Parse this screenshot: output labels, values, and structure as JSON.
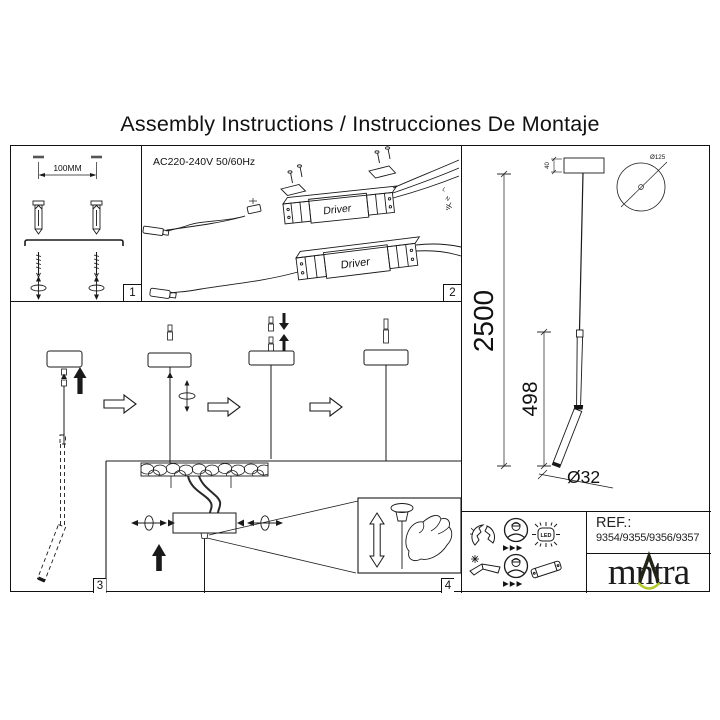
{
  "title": "Assembly Instructions / Instrucciones De Montaje",
  "panel1": {
    "label": "1",
    "dim_label": "100MM"
  },
  "panel2": {
    "label": "2",
    "power": "AC220-240V 50/60Hz",
    "driver_label": "Driver",
    "wire_live": "L",
    "wire_neutral": "N"
  },
  "panel3": {
    "label": "3"
  },
  "panel4": {
    "label": "4"
  },
  "lamp": {
    "total_drop": "2500",
    "body_length": "498",
    "body_diameter": "Ø32",
    "canopy_diameter": "Ø125",
    "canopy_height": "40"
  },
  "safety": {
    "led_label": "LED",
    "arrows": "▶▶▶"
  },
  "footer": {
    "ref_label": "REF.:",
    "ref_numbers": "9354/9355/9356/9357",
    "brand_left": "m",
    "brand_right": "ntra"
  },
  "colors": {
    "line": "#1a1a1a",
    "brand_green": "#b5c930"
  }
}
